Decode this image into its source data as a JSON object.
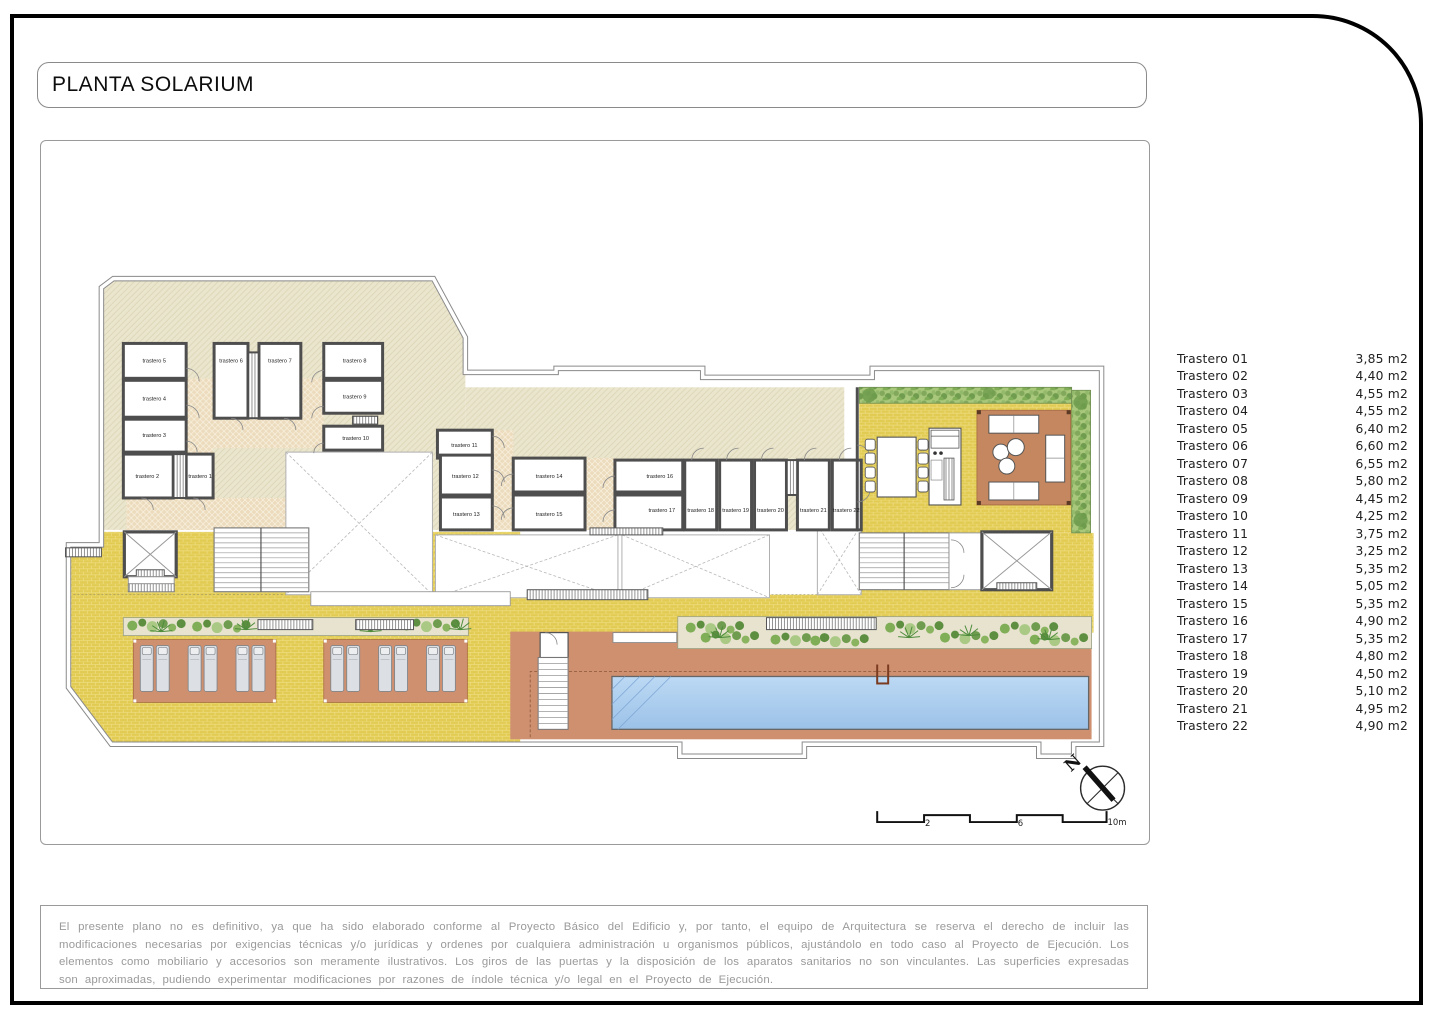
{
  "title": "PLANTA SOLARIUM",
  "legend": {
    "items": [
      {
        "name": "Trastero 01",
        "area": "3,85 m2"
      },
      {
        "name": "Trastero 02",
        "area": "4,40 m2"
      },
      {
        "name": "Trastero 03",
        "area": "4,55 m2"
      },
      {
        "name": "Trastero 04",
        "area": "4,55 m2"
      },
      {
        "name": "Trastero 05",
        "area": "6,40 m2"
      },
      {
        "name": "Trastero 06",
        "area": "6,60 m2"
      },
      {
        "name": "Trastero 07",
        "area": "6,55 m2"
      },
      {
        "name": "Trastero 08",
        "area": "5,80 m2"
      },
      {
        "name": "Trastero 09",
        "area": "4,45 m2"
      },
      {
        "name": "Trastero 10",
        "area": "4,25 m2"
      },
      {
        "name": "Trastero 11",
        "area": "3,75 m2"
      },
      {
        "name": "Trastero 12",
        "area": "3,25 m2"
      },
      {
        "name": "Trastero 13",
        "area": "5,35 m2"
      },
      {
        "name": "Trastero 14",
        "area": "5,05 m2"
      },
      {
        "name": "Trastero 15",
        "area": "5,35 m2"
      },
      {
        "name": "Trastero 16",
        "area": "4,90 m2"
      },
      {
        "name": "Trastero 17",
        "area": "5,35 m2"
      },
      {
        "name": "Trastero 18",
        "area": "4,80 m2"
      },
      {
        "name": "Trastero 19",
        "area": "4,50 m2"
      },
      {
        "name": "Trastero 20",
        "area": "5,10 m2"
      },
      {
        "name": "Trastero 21",
        "area": "4,95 m2"
      },
      {
        "name": "Trastero 22",
        "area": "4,90 m2"
      }
    ]
  },
  "plan": {
    "room_labels": [
      "trastero 1",
      "trastero 2",
      "trastero 3",
      "trastero 4",
      "trastero 5",
      "trastero 6",
      "trastero 7",
      "trastero 8",
      "trastero 9",
      "trastero 10",
      "trastero 11",
      "trastero 12",
      "trastero 13",
      "trastero 14",
      "trastero 15",
      "trastero 16",
      "trastero 17",
      "trastero 18",
      "trastero 19",
      "trastero 20",
      "trastero 21",
      "trastero 22"
    ],
    "north_label": "N",
    "scale_labels": [
      "2",
      "6",
      "10m"
    ]
  },
  "colors": {
    "hatch_bg": "#eae5cd",
    "paving_yellow": "#e2cb52",
    "hedge_green": "#a9c87c",
    "terracotta": "#cf9070",
    "pool_blue": "#aecdf0",
    "wall_gray": "#4e4e4e"
  },
  "disclaimer": "El presente plano no es definitivo, ya que ha sido elaborado conforme al Proyecto Básico del Edificio y, por tanto, el equipo de Arquitectura se reserva el derecho de incluir las modificaciones necesarias por exigencias técnicas y/o jurídicas y ordenes por cualquiera administración u organismos públicos, ajustándolo en todo caso al Proyecto de Ejecución. Los elementos como mobiliario y accesorios son meramente ilustrativos. Los giros de las puertas y la disposición de los aparatos sanitarios no son vinculantes. Las superficies expresadas son aproximadas, pudiendo experimentar modificaciones por razones de índole técnica y/o legal en el Proyecto de Ejecución."
}
